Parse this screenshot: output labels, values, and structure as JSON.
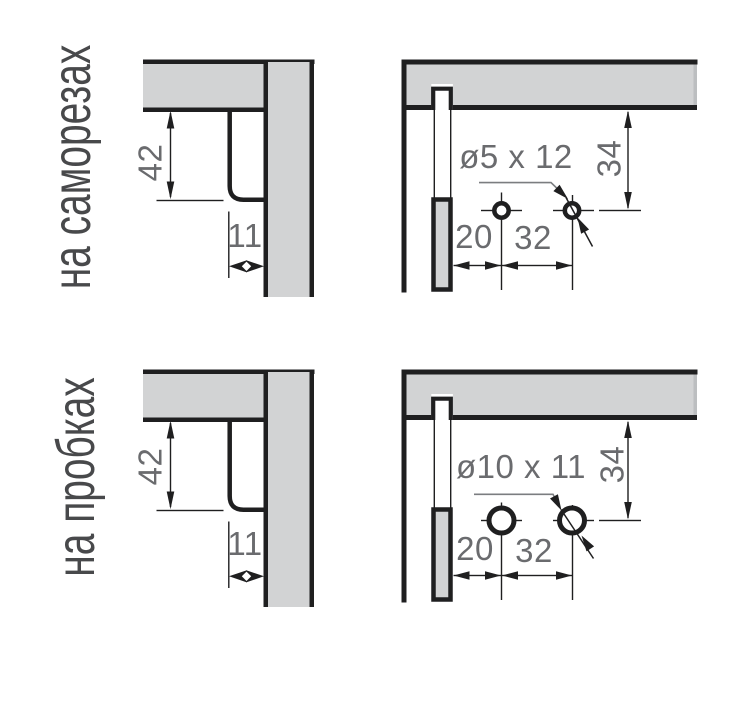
{
  "figure": {
    "title_hidden": "",
    "rows": [
      {
        "row_label": "на саморезах",
        "left_diagram": {
          "dim_height": "42",
          "dim_width": "11"
        },
        "right_diagram": {
          "hole_callout": "ø5 x 12",
          "dim_from_top": "34",
          "dim_from_edge": "20",
          "dim_spacing": "32"
        }
      },
      {
        "row_label": "на пробках",
        "left_diagram": {
          "dim_height": "42",
          "dim_width": "11"
        },
        "right_diagram": {
          "hole_callout": "ø10 x 11",
          "dim_from_top": "34",
          "dim_from_edge": "20",
          "dim_spacing": "32"
        }
      }
    ],
    "colors": {
      "panel_fill": "#d2d3d4",
      "panel_edge_cap": "#bcbec0",
      "line": "#1f1f20",
      "dim_text": "#6a6b6e",
      "label_text": "#48494b",
      "leader_line": "#7b7d80",
      "background": "#ffffff"
    }
  }
}
